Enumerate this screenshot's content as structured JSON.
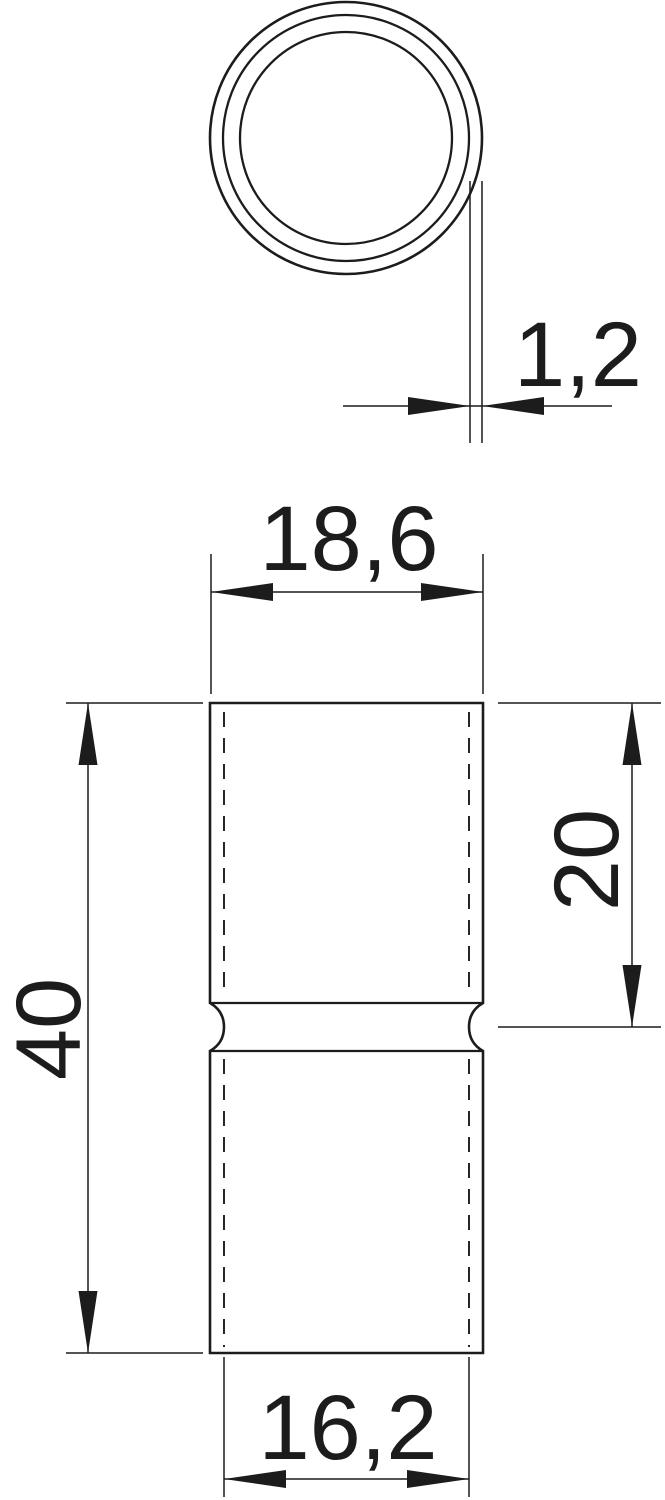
{
  "drawing": {
    "dimensions": {
      "wall_thickness": "1,2",
      "outer_diameter": "18,6",
      "overall_length": "40",
      "insertion_depth": "20",
      "inner_diameter": "16,2"
    },
    "colors": {
      "line": "#1c1c1c",
      "background": "#ffffff"
    }
  }
}
